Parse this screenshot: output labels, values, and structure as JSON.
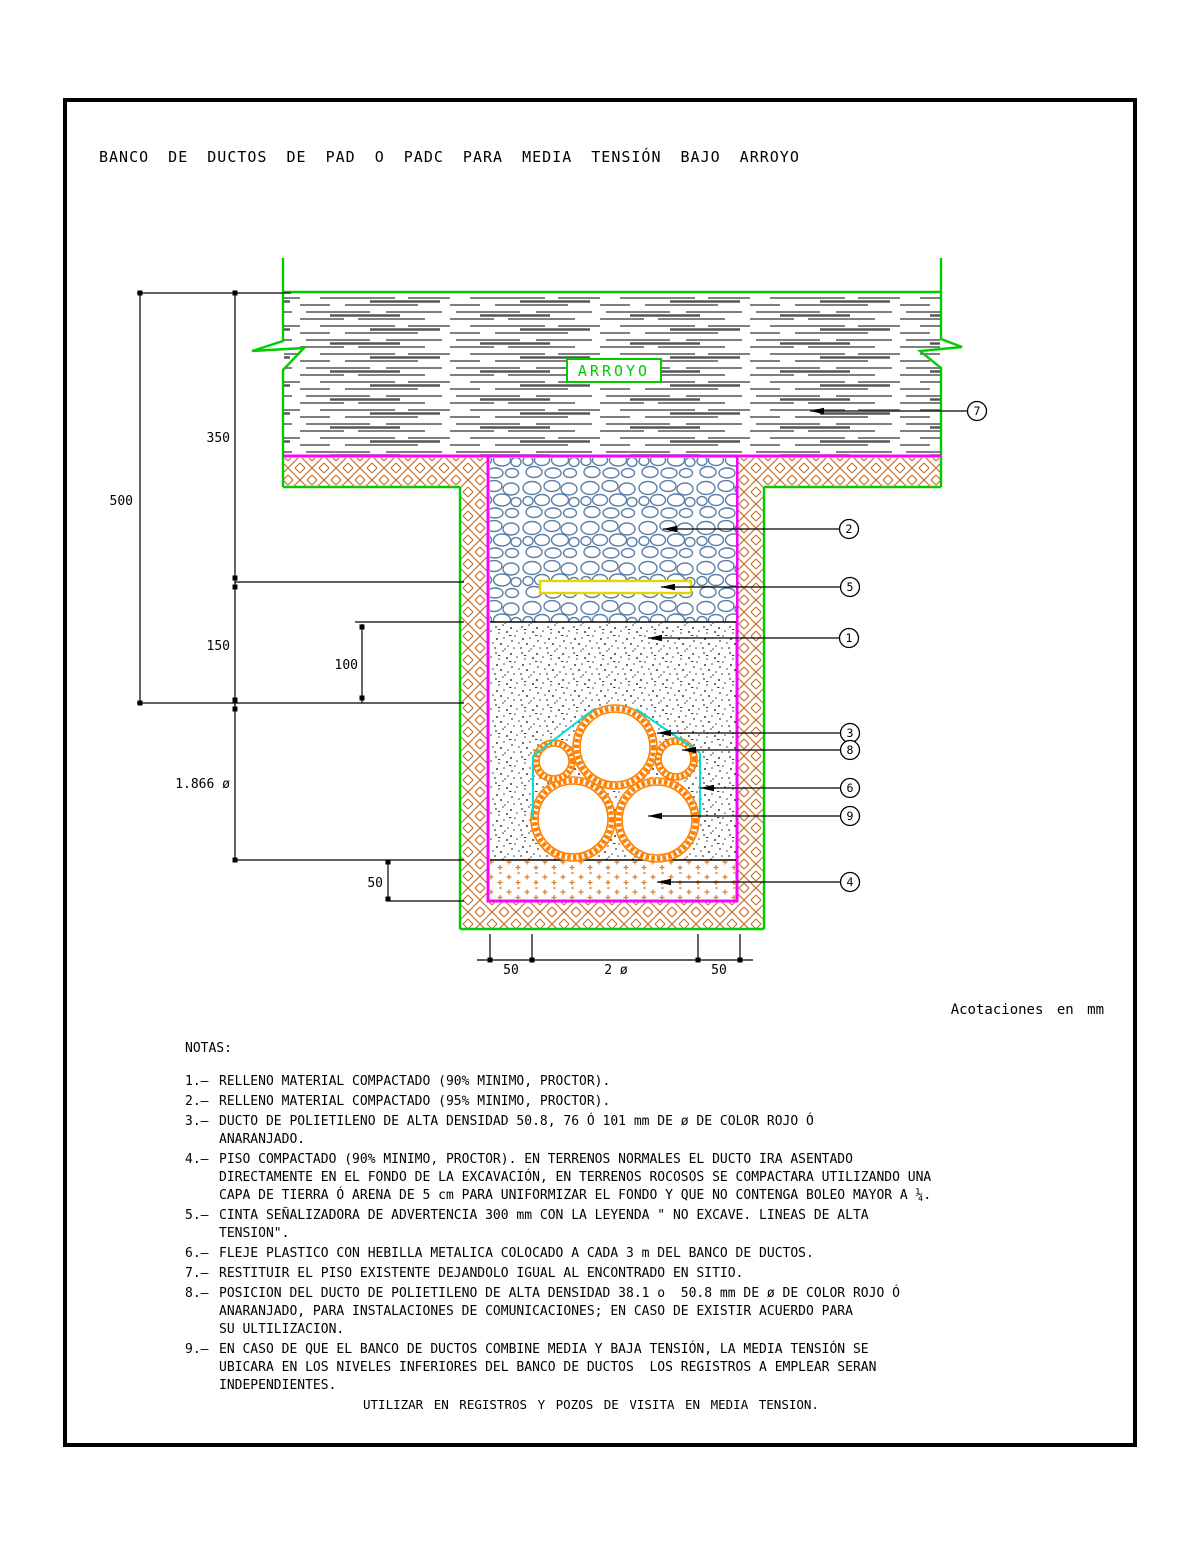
{
  "title": "BANCO DE DUCTOS DE PAD O PADC PARA MEDIA TENSIÓN BAJO ARROYO",
  "drawing": {
    "arroyo_label": "ARROYO",
    "dimensions": {
      "d500": "500",
      "d350": "350",
      "d150": "150",
      "d100": "100",
      "d1866": "1.866 ø",
      "d50_left": "50",
      "d50_bottom_left": "50",
      "d2dia": "2 ø",
      "d50_bottom_right": "50"
    },
    "callouts": {
      "c1": "1",
      "c2": "2",
      "c3": "3",
      "c4": "4",
      "c5": "5",
      "c6": "6",
      "c7": "7",
      "c8": "8",
      "c9": "9"
    },
    "colors": {
      "green": "#00cc00",
      "magenta": "#ff00ff",
      "hatch_orange": "#c96f2a",
      "duct_orange": "#ff8000",
      "strap_cyan": "#00dcdc",
      "tape_yellow": "#e0d800",
      "cobble_blue": "#5c80a8"
    }
  },
  "acotaciones": "Acotaciones en mm",
  "notes": {
    "heading": "NOTAS:",
    "items": [
      {
        "num": "1.–",
        "text": "RELLENO MATERIAL COMPACTADO (90% MINIMO, PROCTOR)."
      },
      {
        "num": "2.–",
        "text": "RELLENO MATERIAL COMPACTADO (95% MINIMO, PROCTOR)."
      },
      {
        "num": "3.–",
        "text": "DUCTO DE POLIETILENO DE ALTA DENSIDAD 50.8, 76 Ó 101 mm DE ø DE COLOR ROJO Ó\nANARANJADO."
      },
      {
        "num": "4.–",
        "text": "PISO COMPACTADO (90% MINIMO, PROCTOR). EN TERRENOS NORMALES EL DUCTO IRA ASENTADO\nDIRECTAMENTE EN EL FONDO DE LA EXCAVACIÓN, EN TERRENOS ROCOSOS SE COMPACTARA UTILIZANDO UNA\nCAPA DE TIERRA Ó ARENA DE 5 cm PARA UNIFORMIZAR EL FONDO Y QUE NO CONTENGA BOLEO MAYOR A ¼."
      },
      {
        "num": "5.–",
        "text": "CINTA SEÑALIZADORA DE ADVERTENCIA 300 mm CON LA LEYENDA \" NO EXCAVE. LINEAS DE ALTA\nTENSION\"."
      },
      {
        "num": "6.–",
        "text": "FLEJE PLASTICO CON HEBILLA METALICA COLOCADO A CADA 3 m DEL BANCO DE DUCTOS."
      },
      {
        "num": "7.–",
        "text": "RESTITUIR EL PISO EXISTENTE DEJANDOLO IGUAL AL ENCONTRADO EN SITIO."
      },
      {
        "num": "8.–",
        "text": "POSICION DEL DUCTO DE POLIETILENO DE ALTA DENSIDAD 38.1 o  50.8 mm DE ø DE COLOR ROJO Ó\nANARANJADO, PARA INSTALACIONES DE COMUNICACIONES; EN CASO DE EXISTIR ACUERDO PARA\nSU ULTILIZACION."
      },
      {
        "num": "9.–",
        "text": "EN CASO DE QUE EL BANCO DE DUCTOS COMBINE MEDIA Y BAJA TENSIÓN, LA MEDIA TENSIÓN SE\nUBICARA EN LOS NIVELES INFERIORES DEL BANCO DE DUCTOS  LOS REGISTROS A EMPLEAR SERAN\nINDEPENDIENTES."
      }
    ]
  },
  "footer": "UTILIZAR EN REGISTROS Y POZOS DE VISITA EN MEDIA TENSION."
}
